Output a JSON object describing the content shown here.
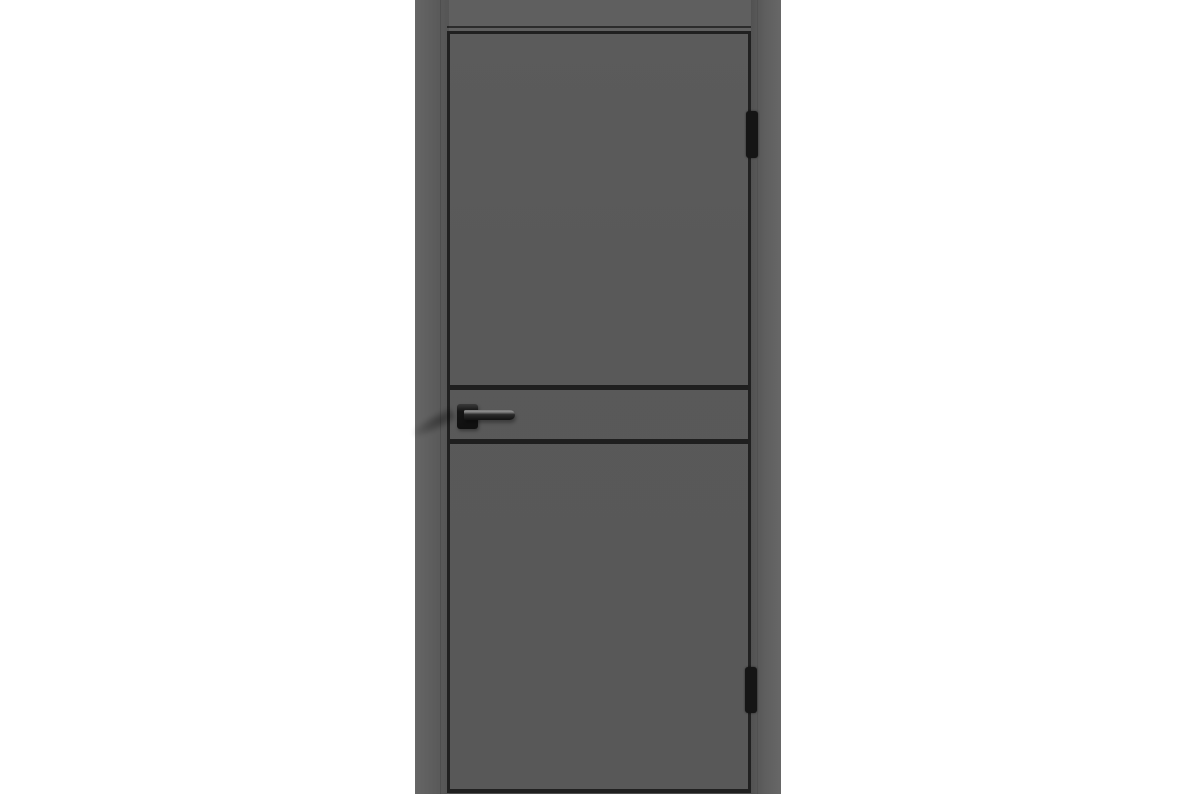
{
  "image": {
    "type": "product-photo",
    "subject": "interior door with frame, graphite gray finish, black hardware",
    "background": "plain white, no text or watermark"
  },
  "colors": {
    "background": "#ffffff",
    "frame": "#5f5f5f",
    "frame_edge": "#4c4c4c",
    "leaf": "#595959",
    "outline": "#202020",
    "groove": "#1f1f1f",
    "hardware": "#151515",
    "hardware_highlight": "#7a7a7a"
  },
  "parts": {
    "frame": "door frame with lintel and side jambs",
    "leaf": "flat door leaf with dark edge outline",
    "grooves": [
      "upper horizontal black groove",
      "lower horizontal black groove"
    ],
    "hinges": [
      "top hinge, right edge",
      "bottom hinge, right edge"
    ],
    "handle": "square rosette with straight lever pointing right"
  }
}
